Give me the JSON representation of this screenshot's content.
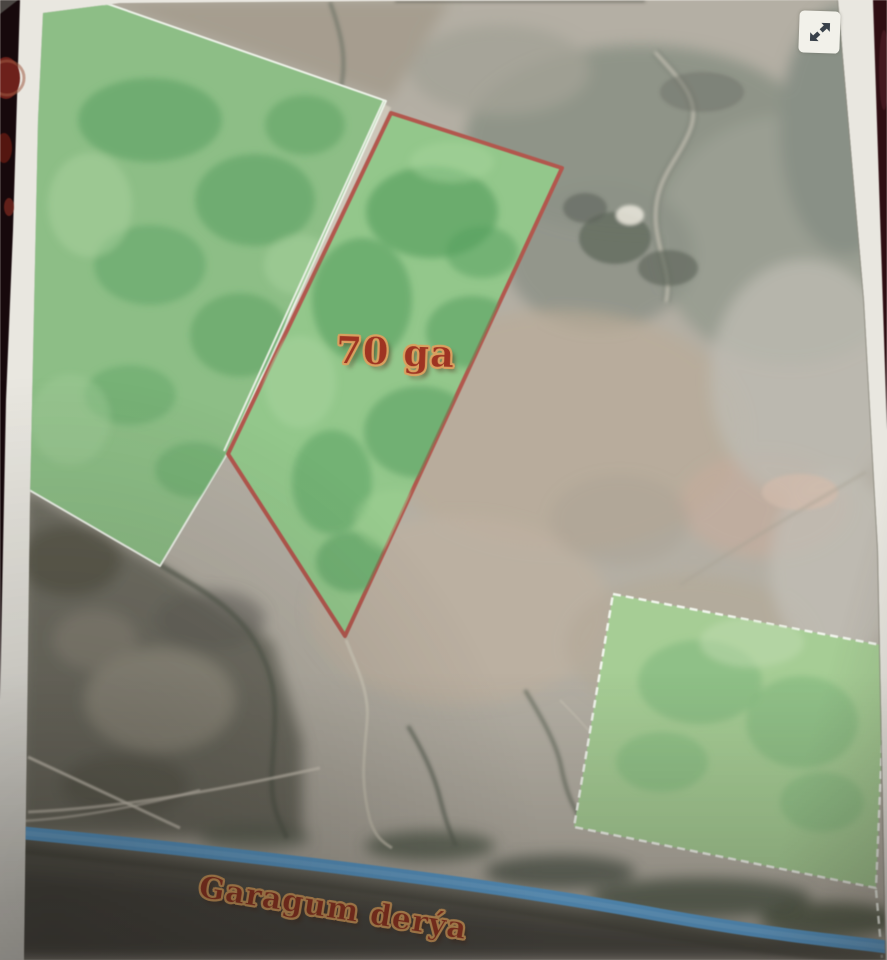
{
  "photo": {
    "description": "printed satellite land map on dark red carpet",
    "paper_color": "#e9e7e0",
    "background_color": "#1a0b0e"
  },
  "map": {
    "parcel": {
      "label": "70 ga",
      "outline_color": "#b4564c",
      "fill_color": "#92c78a"
    },
    "river": {
      "label": "Garagum derýa",
      "color": "#5aa1d8"
    },
    "fields": {
      "west_field_color": "#8cbe85",
      "southeast_field_color": "#a5cd94",
      "boundary_line_color": "#eef2e9"
    },
    "terrain": {
      "desert_color": "#b4afa4",
      "dark_lowland_color": "#55534b"
    },
    "toolbar": {
      "icon": "expand-arrows-icon",
      "icon_color": "#39414a"
    },
    "label_style": {
      "text_color": "#9e3422",
      "outline_color": "#d9a05f"
    }
  }
}
